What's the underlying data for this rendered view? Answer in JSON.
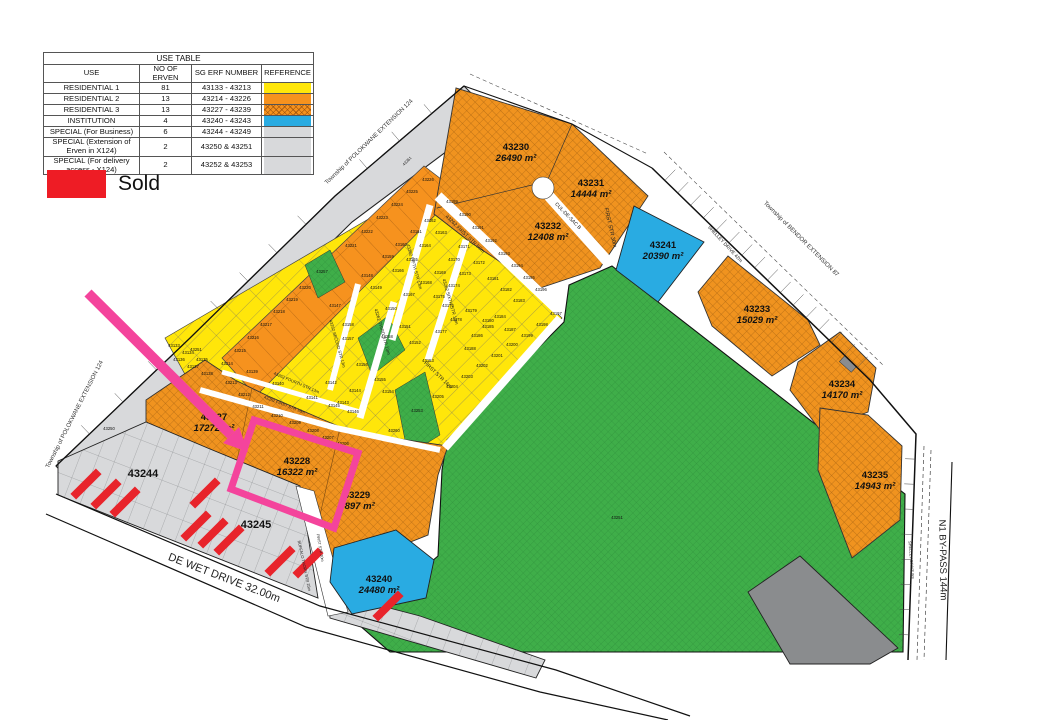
{
  "legend_table": {
    "title": "USE TABLE",
    "headers": [
      "USE",
      "NO OF ERVEN",
      "SG ERF NUMBER",
      "REFERENCE"
    ],
    "rows": [
      {
        "use": "RESIDENTIAL 1",
        "count": "81",
        "erf": "43133 - 43213",
        "ref": "yellow"
      },
      {
        "use": "RESIDENTIAL 2",
        "count": "13",
        "erf": "43214 - 43226",
        "ref": "orange"
      },
      {
        "use": "RESIDENTIAL 3",
        "count": "13",
        "erf": "43227 - 43239",
        "ref": "orange-hatch"
      },
      {
        "use": "INSTITUTION",
        "count": "4",
        "erf": "43240 - 43243",
        "ref": "blue"
      },
      {
        "use": "SPECIAL (For Business)",
        "count": "6",
        "erf": "43244 - 43249",
        "ref": "gray"
      },
      {
        "use": "SPECIAL (Extension of Erven in X124)",
        "count": "2",
        "erf": "43250 & 43251",
        "ref": "gray"
      },
      {
        "use": "SPECIAL (For delivery access - X124)",
        "count": "2",
        "erf": "43252 & 43253",
        "ref": "gray"
      }
    ]
  },
  "sold_legend": {
    "label": "Sold",
    "color": "#ee1c25"
  },
  "colors": {
    "yellow": "#ffe60a",
    "orange": "#f6921e",
    "orange-hatch": "#f6921e",
    "blue": "#29abe2",
    "green": "#3fae49",
    "gray": "#d8d9db",
    "dark_gray": "#8a8c8e",
    "pink": "#f4449c",
    "red": "#e8242b"
  },
  "map": {
    "townships": [
      {
        "t": "Township of POLOKWANE EXTENSION 124",
        "x": 370,
        "y": 143,
        "r": -44
      },
      {
        "t": "Township of POLOKWANE EXTENSION 124",
        "x": 76,
        "y": 415,
        "r": -63
      },
      {
        "t": "Township of BENDOR EXTENSION 87",
        "x": 800,
        "y": 240,
        "r": 45
      }
    ],
    "plots": [
      {
        "id": "43230",
        "area": "26490 m²",
        "x": 516,
        "y": 150
      },
      {
        "id": "43231",
        "area": "14444 m²",
        "x": 591,
        "y": 186
      },
      {
        "id": "43232",
        "area": "12408 m²",
        "x": 548,
        "y": 229
      },
      {
        "id": "43241",
        "area": "20390 m²",
        "x": 663,
        "y": 248
      },
      {
        "id": "43233",
        "area": "15029 m²",
        "x": 757,
        "y": 312
      },
      {
        "id": "43234",
        "area": "14170 m²",
        "x": 842,
        "y": 387
      },
      {
        "id": "43235",
        "area": "14943 m²",
        "x": 875,
        "y": 478
      },
      {
        "id": "43240",
        "area": "24480 m²",
        "x": 379,
        "y": 582
      },
      {
        "id": "43227",
        "area": "17272 m²",
        "x": 214,
        "y": 420
      },
      {
        "id": "43228",
        "area": "16322 m²",
        "x": 297,
        "y": 464
      },
      {
        "id": "43229",
        "area": "9897 m²",
        "x": 357,
        "y": 498
      },
      {
        "id": "43244",
        "area": "",
        "x": 143,
        "y": 477,
        "s": 11
      },
      {
        "id": "43245",
        "area": "",
        "x": 256,
        "y": 528,
        "s": 11
      }
    ],
    "streets": [
      {
        "t": "CUL-DE-SAC B",
        "x": 567,
        "y": 217,
        "r": 46,
        "s": 5
      },
      {
        "t": "FIRST STR 30m",
        "x": 609,
        "y": 228,
        "r": 77,
        "s": 5.5
      },
      {
        "t": "43262 FIRST STR 56m",
        "x": 464,
        "y": 235,
        "r": 44,
        "s": 5
      },
      {
        "t": "43262 FIFTH STR 13m",
        "x": 413,
        "y": 267,
        "r": 74,
        "s": 4.5
      },
      {
        "t": "43262 SIXTH STR 13m",
        "x": 449,
        "y": 302,
        "r": 74,
        "s": 4.5
      },
      {
        "t": "43262 THIRD STR 13m",
        "x": 381,
        "y": 332,
        "r": 74,
        "s": 4.5
      },
      {
        "t": "43262 SECOND STR 13m",
        "x": 336,
        "y": 344,
        "r": 74,
        "s": 4.2
      },
      {
        "t": "43262 FOURTH STR 13m",
        "x": 296,
        "y": 384,
        "r": 23,
        "s": 4.2
      },
      {
        "t": "43262 FIRST STR 16m",
        "x": 284,
        "y": 406,
        "r": 21,
        "s": 4.2
      },
      {
        "t": "FIRST STR 16m",
        "x": 437,
        "y": 376,
        "r": 44,
        "s": 5
      },
      {
        "t": "FIRST STR 20m",
        "x": 319,
        "y": 548,
        "r": 80,
        "s": 3.8
      },
      {
        "t": "BUFFALO THORN STR 25m",
        "x": 303,
        "y": 566,
        "r": 78,
        "s": 4
      },
      {
        "t": "DE WET DRIVE 32.00m",
        "x": 223,
        "y": 581,
        "r": 21,
        "s": 11
      },
      {
        "t": "SHELLEY DRIVE 42m",
        "x": 724,
        "y": 245,
        "r": 47,
        "s": 4.8
      },
      {
        "t": "SHELLEY DRIVE 9m",
        "x": 910,
        "y": 560,
        "r": 85,
        "s": 4
      },
      {
        "t": "N1 BY-PASS 144m",
        "x": 940,
        "y": 560,
        "r": 89,
        "s": 9.5
      },
      {
        "t": "43261",
        "x": 408,
        "y": 162,
        "r": -46,
        "s": 4
      }
    ],
    "small_labels": [
      {
        "t": "43214",
        "x": 227,
        "y": 365
      },
      {
        "t": "43215",
        "x": 240,
        "y": 352
      },
      {
        "t": "43216",
        "x": 253,
        "y": 339
      },
      {
        "t": "43217",
        "x": 266,
        "y": 326
      },
      {
        "t": "43218",
        "x": 279,
        "y": 313
      },
      {
        "t": "43219",
        "x": 292,
        "y": 301
      },
      {
        "t": "43220",
        "x": 305,
        "y": 289
      },
      {
        "t": "43221",
        "x": 351,
        "y": 247
      },
      {
        "t": "43222",
        "x": 367,
        "y": 233
      },
      {
        "t": "43223",
        "x": 382,
        "y": 219
      },
      {
        "t": "43224",
        "x": 397,
        "y": 206
      },
      {
        "t": "43225",
        "x": 412,
        "y": 193
      },
      {
        "t": "43226",
        "x": 428,
        "y": 181
      },
      {
        "t": "43133",
        "x": 174,
        "y": 347
      },
      {
        "t": "43134",
        "x": 188,
        "y": 354
      },
      {
        "t": "43135",
        "x": 202,
        "y": 361
      },
      {
        "t": "43136",
        "x": 179,
        "y": 361
      },
      {
        "t": "43137",
        "x": 193,
        "y": 368
      },
      {
        "t": "43138",
        "x": 207,
        "y": 375
      },
      {
        "t": "43139",
        "x": 252,
        "y": 373
      },
      {
        "t": "43140",
        "x": 278,
        "y": 385
      },
      {
        "t": "43141",
        "x": 312,
        "y": 399
      },
      {
        "t": "43142",
        "x": 331,
        "y": 384
      },
      {
        "t": "43143",
        "x": 343,
        "y": 404
      },
      {
        "t": "43144",
        "x": 355,
        "y": 392
      },
      {
        "t": "43145",
        "x": 334,
        "y": 407
      },
      {
        "t": "43146",
        "x": 353,
        "y": 413
      },
      {
        "t": "43147",
        "x": 335,
        "y": 307
      },
      {
        "t": "43148",
        "x": 367,
        "y": 277
      },
      {
        "t": "43149",
        "x": 376,
        "y": 289
      },
      {
        "t": "43150",
        "x": 391,
        "y": 310
      },
      {
        "t": "43151",
        "x": 405,
        "y": 328
      },
      {
        "t": "43152",
        "x": 415,
        "y": 344
      },
      {
        "t": "43153",
        "x": 428,
        "y": 362
      },
      {
        "t": "43154",
        "x": 388,
        "y": 393
      },
      {
        "t": "43155",
        "x": 380,
        "y": 381
      },
      {
        "t": "43156",
        "x": 362,
        "y": 366
      },
      {
        "t": "43157",
        "x": 348,
        "y": 340
      },
      {
        "t": "43158",
        "x": 348,
        "y": 326
      },
      {
        "t": "43159",
        "x": 388,
        "y": 258
      },
      {
        "t": "43160",
        "x": 401,
        "y": 246
      },
      {
        "t": "43161",
        "x": 416,
        "y": 233
      },
      {
        "t": "43162",
        "x": 430,
        "y": 222
      },
      {
        "t": "43163",
        "x": 441,
        "y": 234
      },
      {
        "t": "43164",
        "x": 425,
        "y": 247
      },
      {
        "t": "43165",
        "x": 412,
        "y": 261
      },
      {
        "t": "43166",
        "x": 398,
        "y": 272
      },
      {
        "t": "43167",
        "x": 409,
        "y": 296
      },
      {
        "t": "43168",
        "x": 426,
        "y": 284
      },
      {
        "t": "43169",
        "x": 440,
        "y": 274
      },
      {
        "t": "43170",
        "x": 454,
        "y": 261
      },
      {
        "t": "43171",
        "x": 464,
        "y": 248
      },
      {
        "t": "43172",
        "x": 479,
        "y": 264
      },
      {
        "t": "43173",
        "x": 465,
        "y": 275
      },
      {
        "t": "43174",
        "x": 454,
        "y": 287
      },
      {
        "t": "43175",
        "x": 439,
        "y": 298
      },
      {
        "t": "43176",
        "x": 448,
        "y": 307
      },
      {
        "t": "43177",
        "x": 441,
        "y": 333
      },
      {
        "t": "43178",
        "x": 456,
        "y": 321
      },
      {
        "t": "43179",
        "x": 471,
        "y": 312
      },
      {
        "t": "43180",
        "x": 488,
        "y": 322
      },
      {
        "t": "43181",
        "x": 493,
        "y": 280
      },
      {
        "t": "43182",
        "x": 506,
        "y": 291
      },
      {
        "t": "43183",
        "x": 519,
        "y": 302
      },
      {
        "t": "43184",
        "x": 500,
        "y": 318
      },
      {
        "t": "43185",
        "x": 488,
        "y": 328
      },
      {
        "t": "43186",
        "x": 477,
        "y": 337
      },
      {
        "t": "43187",
        "x": 510,
        "y": 331
      },
      {
        "t": "43188",
        "x": 470,
        "y": 350
      },
      {
        "t": "43189",
        "x": 452,
        "y": 203
      },
      {
        "t": "43190",
        "x": 465,
        "y": 216
      },
      {
        "t": "43191",
        "x": 478,
        "y": 229
      },
      {
        "t": "43192",
        "x": 491,
        "y": 242
      },
      {
        "t": "43193",
        "x": 504,
        "y": 255
      },
      {
        "t": "43194",
        "x": 517,
        "y": 267
      },
      {
        "t": "43195",
        "x": 529,
        "y": 279
      },
      {
        "t": "43196",
        "x": 541,
        "y": 291
      },
      {
        "t": "43197",
        "x": 556,
        "y": 315
      },
      {
        "t": "43198",
        "x": 542,
        "y": 326
      },
      {
        "t": "43199",
        "x": 527,
        "y": 337
      },
      {
        "t": "43200",
        "x": 512,
        "y": 346
      },
      {
        "t": "43201",
        "x": 497,
        "y": 357
      },
      {
        "t": "43202",
        "x": 482,
        "y": 367
      },
      {
        "t": "43203",
        "x": 467,
        "y": 378
      },
      {
        "t": "43204",
        "x": 452,
        "y": 388
      },
      {
        "t": "43205",
        "x": 438,
        "y": 398
      },
      {
        "t": "43206",
        "x": 343,
        "y": 445
      },
      {
        "t": "43207",
        "x": 328,
        "y": 439
      },
      {
        "t": "43208",
        "x": 313,
        "y": 432
      },
      {
        "t": "43209",
        "x": 295,
        "y": 424
      },
      {
        "t": "43210",
        "x": 277,
        "y": 417
      },
      {
        "t": "43211",
        "x": 258,
        "y": 408
      },
      {
        "t": "43212",
        "x": 244,
        "y": 396
      },
      {
        "t": "43213",
        "x": 231,
        "y": 384
      },
      {
        "t": "43250",
        "x": 109,
        "y": 430
      },
      {
        "t": "43251",
        "x": 196,
        "y": 351
      },
      {
        "t": "43253",
        "x": 417,
        "y": 412
      },
      {
        "t": "43257",
        "x": 322,
        "y": 273
      },
      {
        "t": "43258",
        "x": 387,
        "y": 338
      },
      {
        "t": "43260",
        "x": 394,
        "y": 432
      },
      {
        "t": "43251",
        "x": 617,
        "y": 519
      }
    ],
    "sold_marks": [
      {
        "x": 86,
        "y": 484
      },
      {
        "x": 106,
        "y": 494
      },
      {
        "x": 125,
        "y": 502
      },
      {
        "x": 205,
        "y": 493
      },
      {
        "x": 196,
        "y": 526
      },
      {
        "x": 213,
        "y": 533
      },
      {
        "x": 229,
        "y": 540
      },
      {
        "x": 280,
        "y": 561
      },
      {
        "x": 308,
        "y": 563
      },
      {
        "x": 388,
        "y": 606
      }
    ]
  }
}
